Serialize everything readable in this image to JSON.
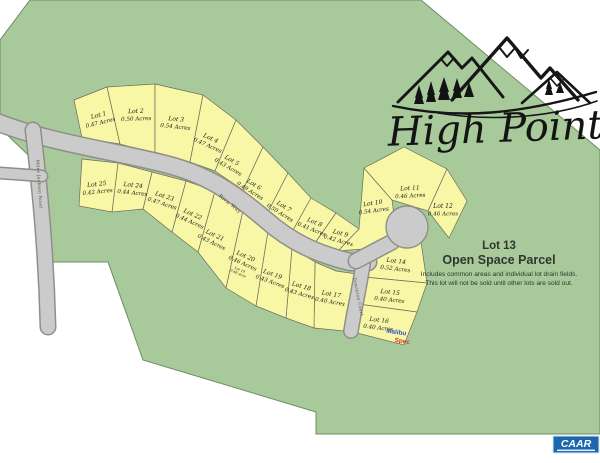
{
  "logo": {
    "title": "High Point"
  },
  "open_space": {
    "title": "Lot 13",
    "subtitle": "Open Space Parcel",
    "body_line1": "Includes common areas and individual lot drain fields.",
    "body_line2": "This lot will not be sold until other lots are sold out."
  },
  "roads": {
    "left_road": "Miles Jackson Road",
    "main_road": "Riva Way",
    "court": "Dominion Court"
  },
  "spec_marker": {
    "brand": "Malibu",
    "label": "Spec",
    "brand_color": "#3a4fc4",
    "label_color": "#c63b2f"
  },
  "badge": {
    "text": "CAAR",
    "color": "#1b66ad"
  },
  "colors": {
    "parcel_green": "#a8ca9b",
    "parcel_outline": "#6d8c62",
    "lot_yellow": "#f8f7a6",
    "road_gray": "#cbcbcb"
  },
  "lots": [
    {
      "id": "Lot 1",
      "acres": "0.47 Acres"
    },
    {
      "id": "Lot 2",
      "acres": "0.50 Acres"
    },
    {
      "id": "Lot 3",
      "acres": "0.54 Acres"
    },
    {
      "id": "Lot 4",
      "acres": "0.47 Acres"
    },
    {
      "id": "Lot 5",
      "acres": "0.43 Acres"
    },
    {
      "id": "Lot 6",
      "acres": "0.49 Acres"
    },
    {
      "id": "Lot 7",
      "acres": "0.50 Acres"
    },
    {
      "id": "Lot 8",
      "acres": "0.41 Acres"
    },
    {
      "id": "Lot 9",
      "acres": "0.42 Acres"
    },
    {
      "id": "Lot 10",
      "acres": "0.54 Acres"
    },
    {
      "id": "Lot 11",
      "acres": "0.46 Acres"
    },
    {
      "id": "Lot 12",
      "acres": "0.46 Acres"
    },
    {
      "id": "Lot 14",
      "acres": "0.52 Acres"
    },
    {
      "id": "Lot 15",
      "acres": "0.40 Acres"
    },
    {
      "id": "Lot 16",
      "acres": "0.40 Acres"
    },
    {
      "id": "Lot 17",
      "acres": "0.40 Acres"
    },
    {
      "id": "Lot 18",
      "acres": "0.43 Acres"
    },
    {
      "id": "Lot 19",
      "acres": "0.43 Acres"
    },
    {
      "id": "Lot 20",
      "acres": "0.46 Acres",
      "note_line1": "Lot 19",
      "note_line2": "0.48 Acre"
    },
    {
      "id": "Lot 21",
      "acres": "0.43 Acres"
    },
    {
      "id": "Lot 22",
      "acres": "0.44 Acres"
    },
    {
      "id": "Lot 23",
      "acres": "0.47 Acres"
    },
    {
      "id": "Lot 24",
      "acres": "0.44 Acres"
    },
    {
      "id": "Lot 25",
      "acres": "0.42 Acres"
    }
  ]
}
